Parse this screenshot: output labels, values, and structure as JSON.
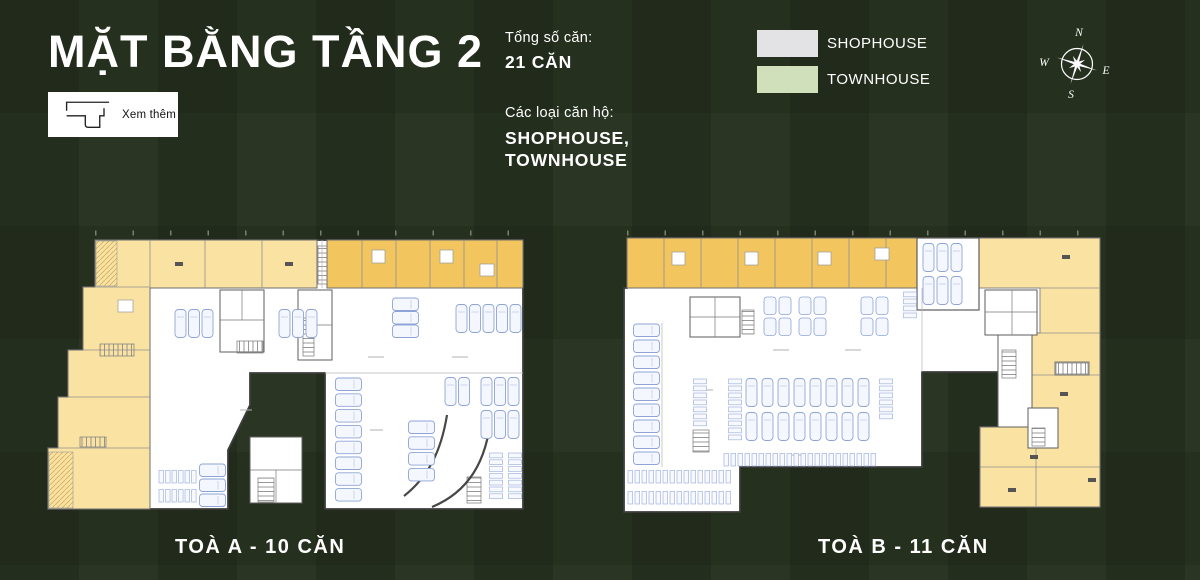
{
  "header": {
    "title": "MẶT BẰNG TẦNG 2",
    "see_more_label": "Xem thêm"
  },
  "stats": {
    "total_label": "Tổng số căn:",
    "total_value": "21 CĂN",
    "types_label": "Các loại căn hộ:",
    "types_line1": "SHOPHOUSE,",
    "types_line2": "TOWNHOUSE"
  },
  "legend": {
    "items": [
      {
        "label": "SHOPHOUSE",
        "color": "#e3e3e6"
      },
      {
        "label": "TOWNHOUSE",
        "color": "#cfe0ba"
      }
    ]
  },
  "compass": {
    "n": "N",
    "e": "E",
    "s": "S",
    "w": "W"
  },
  "plans": {
    "a": {
      "caption": "TOÀ A - 10 CĂN"
    },
    "b": {
      "caption": "TOÀ B - 11 CĂN"
    }
  },
  "colors": {
    "background": "#2a3523",
    "unit_cream": "#fae3a2",
    "unit_gold": "#f2c55f",
    "plan_white": "#ffffff",
    "stall_blue": "#8ea4d8"
  }
}
